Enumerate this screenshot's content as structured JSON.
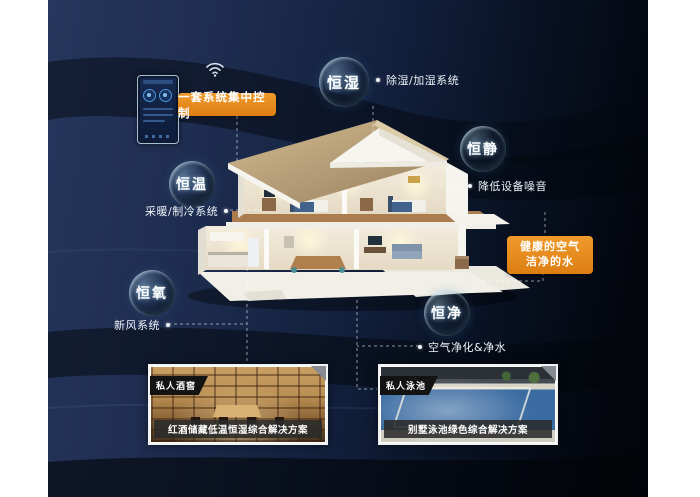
{
  "panel": {
    "description": "smart-home constant-comfort infographic",
    "bg_left_color": "#26365c",
    "bg_right_color": "#02040a"
  },
  "control": {
    "label": "一套系统集中控制",
    "device": "wall-mounted smart controller with wifi"
  },
  "bubbles": [
    {
      "label": "恒湿",
      "note": "除湿/加湿系统"
    },
    {
      "label": "恒静",
      "note": "降低设备噪音"
    },
    {
      "label": "恒温",
      "note": "采暖/制冷系统"
    },
    {
      "label": "恒氧",
      "note": "新风系统"
    },
    {
      "label": "恒净",
      "note": "空气净化&净水"
    }
  ],
  "highlight": {
    "line1": "健康的空气",
    "line2": "洁净的水",
    "color": "#e88a1c"
  },
  "cards": [
    {
      "tag": "私人酒窖",
      "caption": "红酒储藏低温恒湿综合解决方案"
    },
    {
      "tag": "私人泳池",
      "caption": "别墅泳池绿色综合解决方案"
    }
  ],
  "icons": {
    "wifi": "wifi-icon",
    "connector_style": "white dashed lines with endpoint dots"
  },
  "colors": {
    "accent_orange": "#e88a1c",
    "note_text": "#edf2f8",
    "bubble_text": "#ffffff",
    "roof_tan": "#c3a97d",
    "card_caption_bg": "#2a2a2a"
  }
}
